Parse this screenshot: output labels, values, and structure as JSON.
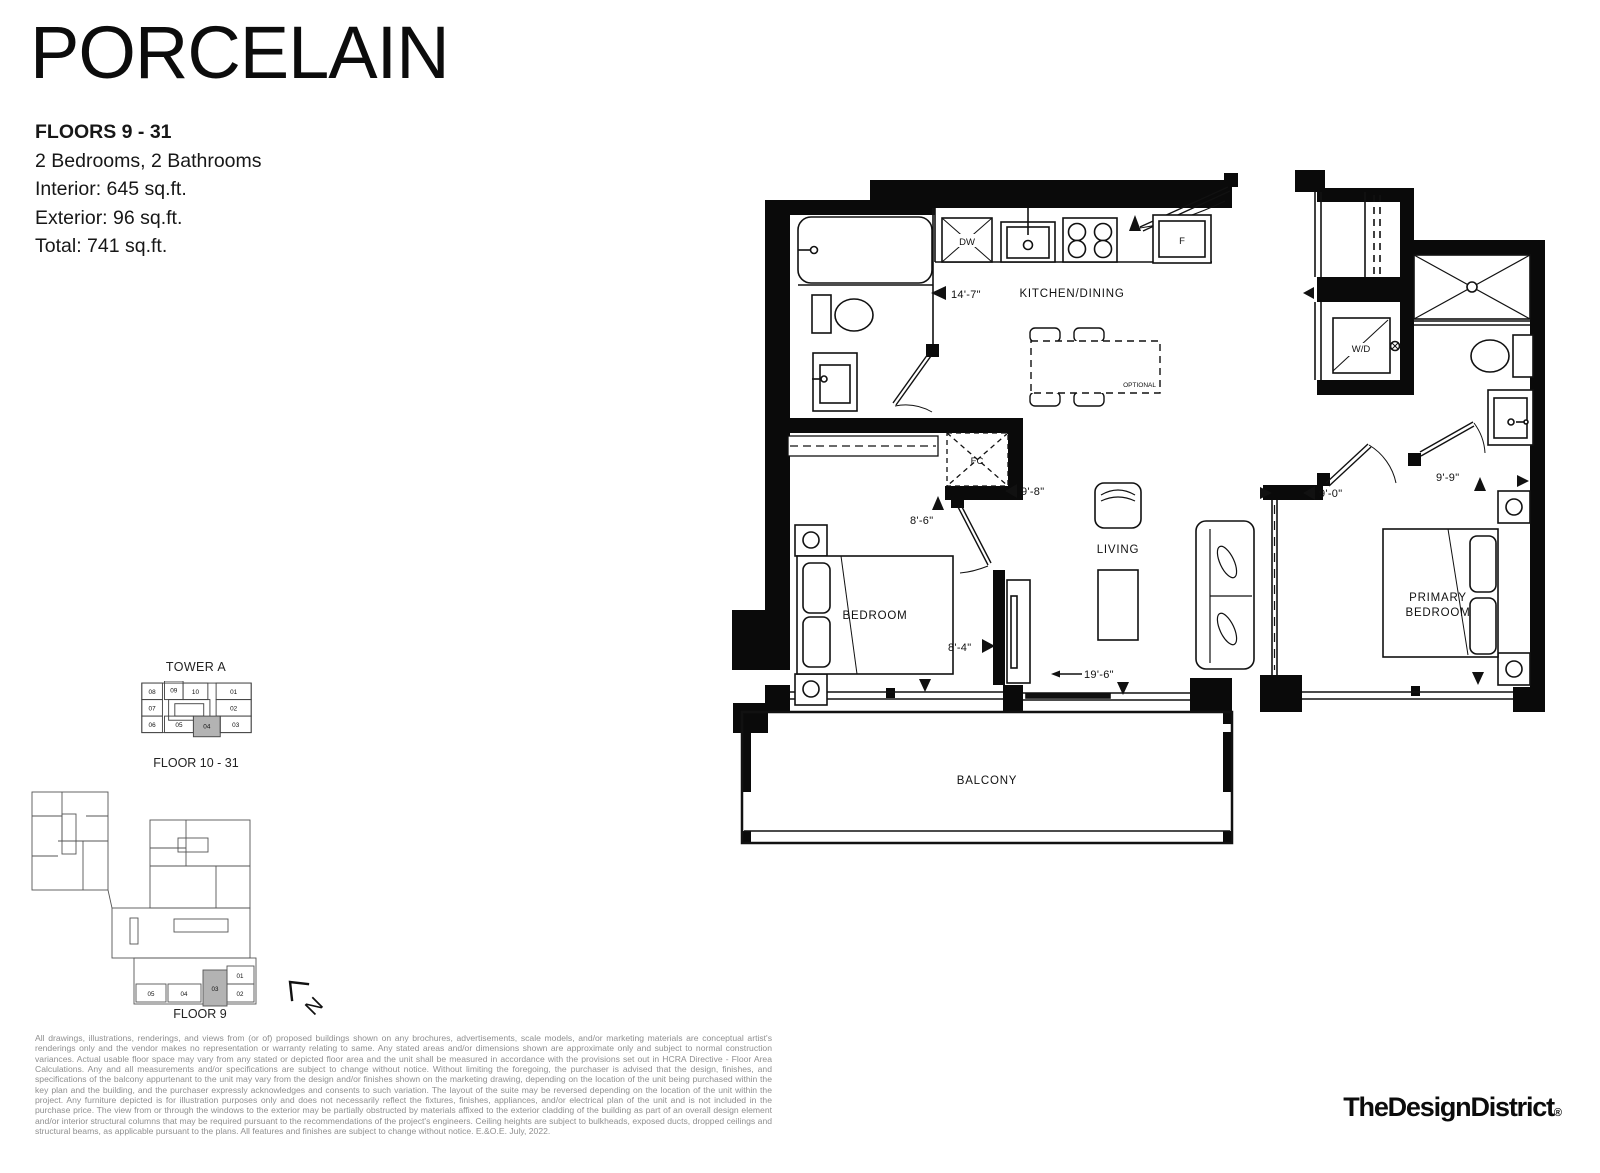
{
  "title": "PORCELAIN",
  "details": {
    "floors": "FLOORS 9 - 31",
    "bed_bath": "2 Bedrooms, 2 Bathrooms",
    "interior": "Interior: 645 sq.ft.",
    "exterior": "Exterior: 96 sq.ft.",
    "total": "Total: 741 sq.ft."
  },
  "plan": {
    "rooms": {
      "kitchen": "KITCHEN/DINING",
      "living": "LIVING",
      "bedroom": "BEDROOM",
      "primary1": "PRIMARY",
      "primary2": "BEDROOM",
      "balcony": "BALCONY"
    },
    "fixtures": {
      "dw": "DW",
      "fridge": "F",
      "wd": "W/D",
      "fc": "FC",
      "optional": "OPTIONAL"
    },
    "dims": {
      "d14_7": "14'-7\"",
      "d9_8": "9'-8\"",
      "d8_6": "8'-6\"",
      "d8_4": "8'-4\"",
      "d9_0": "9'-0\"",
      "d9_9": "9'-9\"",
      "d19_6": "19'-6\""
    }
  },
  "keyplans": {
    "tower_a": {
      "title": "TOWER A",
      "floors_label": "FLOOR 10 - 31",
      "units": {
        "u08": "08",
        "u09": "09",
        "u10": "10",
        "u01": "01",
        "u07": "07",
        "u02": "02",
        "u06": "06",
        "u05": "05",
        "u04": "04",
        "u03": "03"
      }
    },
    "floor9": {
      "label": "FLOOR 9",
      "units": {
        "u01": "01",
        "u02": "02",
        "u03": "03",
        "u04": "04",
        "u05": "05"
      }
    }
  },
  "north_label": "N",
  "disclaimer": "All drawings, illustrations, renderings, and views from (or of) proposed buildings shown on any brochures, advertisements, scale models, and/or marketing materials are conceptual artist's renderings only and the vendor makes no representation or warranty relating to same. Any stated areas and/or dimensions shown are approximate only and subject to normal construction variances. Actual usable floor space may vary from any stated or depicted floor area and the unit shall be measured in accordance with the provisions set out in HCRA Directive - Floor Area Calculations. Any and all measurements and/or specifications are subject to change without notice. Without limiting the foregoing, the purchaser is advised that the design, finishes, and specifications of the balcony appurtenant to the unit may vary from the design and/or finishes shown on the marketing drawing, depending on the location of the unit being purchased within the key plan and the building, and the purchaser expressly acknowledges and consents to such variation. The layout of the suite may be reversed depending on the location of the unit within the project. Any furniture depicted is for illustration purposes only and does not necessarily reflect the fixtures, finishes, appliances, and/or electrical plan of the unit and is not included in the purchase price. The view from or through the windows to the exterior may be partially obstructed by materials affixed to the exterior cladding of the building as part of an overall design element and/or interior structural columns that may be required pursuant to the recommendations of the project's engineers. Ceiling heights are subject to bulkheads, exposed ducts, dropped ceilings and structural beams, as applicable pursuant to the plans. All features and finishes are subject to change without notice. E.&O.E. July, 2022.",
  "brand": {
    "name": "TheDesignDistrict",
    "reg": "®"
  }
}
